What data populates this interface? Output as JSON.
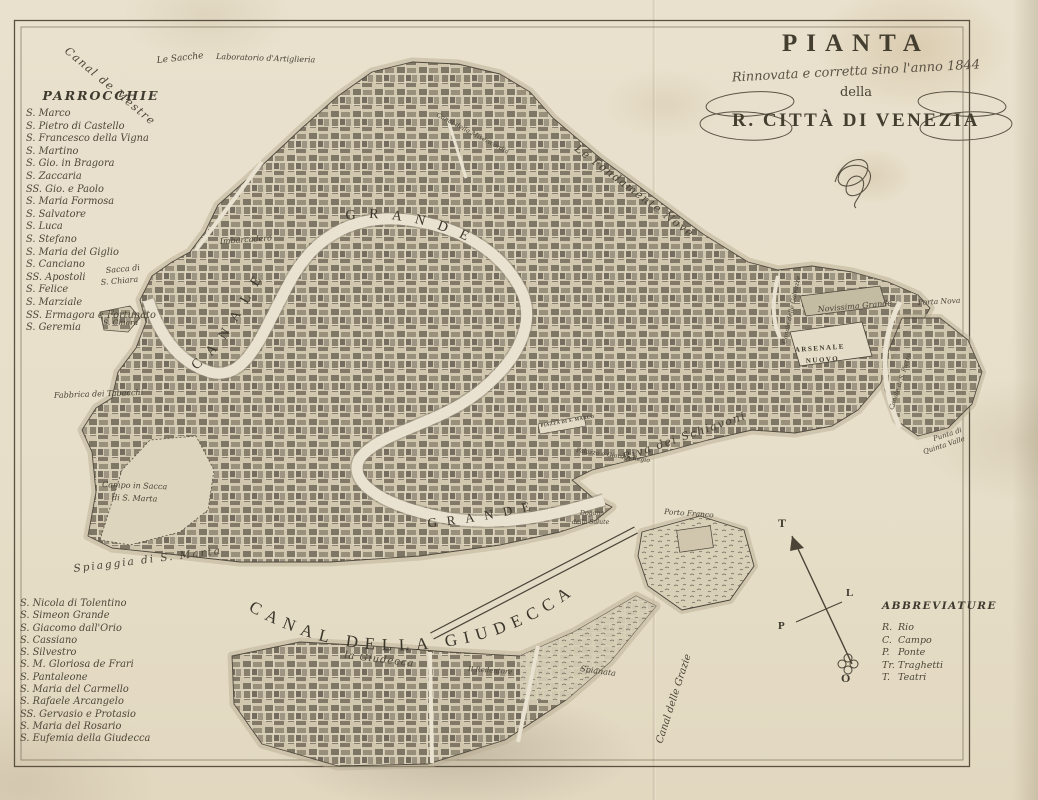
{
  "title_block": {
    "title": "PIANTA",
    "subtitle": "Rinnovata e corretta sino l'anno 1844",
    "della": "della",
    "city": "R. CITTÀ DI VENEZIA"
  },
  "parish_list": {
    "heading": "PARROCCHIE",
    "upper": [
      "S. Marco",
      "S. Pietro di Castello",
      "S. Francesco della Vigna",
      "S. Martino",
      "S. Gio. in Bragora",
      "S. Zaccaria",
      "SS. Gio. e Paolo",
      "S. Maria Formosa",
      "S. Salvatore",
      "S. Luca",
      "S. Stefano",
      "S. Maria del Giglio",
      "S. Canciano",
      "SS. Apostoli",
      "S. Felice",
      "S. Marziale",
      "SS. Ermagora e Fortunato",
      "S. Geremia"
    ],
    "lower": [
      "S. Nicola di Tolentino",
      "S. Simeon Grande",
      "S. Giacomo dall'Orio",
      "S. Cassiano",
      "S. Silvestro",
      "S. M. Gloriosa de Frari",
      "S. Pantaleone",
      "S. Maria del Carmello",
      "S. Rafaele Arcangelo",
      "SS. Gervasio e Protasio",
      "S. Maria del Rosario",
      "S. Eufemia della Giudecca"
    ]
  },
  "abbreviations": {
    "heading": "ABBREVIATURE",
    "items": [
      {
        "abbr": "R.",
        "term": "Rio"
      },
      {
        "abbr": "C.",
        "term": "Campo"
      },
      {
        "abbr": "P.",
        "term": "Ponte"
      },
      {
        "abbr": "Tr.",
        "term": "Traghetti"
      },
      {
        "abbr": "T.",
        "term": "Teatri"
      }
    ]
  },
  "compass": {
    "north": "T",
    "east": "L",
    "west": "P",
    "south": "O"
  },
  "canal_labels": {
    "canal": "CANALE",
    "grande_upper": "GRANDE",
    "grande_lower": "GRANDE",
    "giudecca": "CANAL DELLA GIUDECCA"
  },
  "colors": {
    "paper": "#e8e0cc",
    "ink": "#3f3a2f",
    "island": "#cfc6ad",
    "water": "#eae3d1"
  },
  "map_labels": [
    {
      "name": "label-canal-de-mestre",
      "text": "Canal de Mestre",
      "x": 64,
      "y": 52,
      "rot": 40,
      "size": 11,
      "cls": "script",
      "ls": 1.5
    },
    {
      "name": "label-le-sacche",
      "text": "Le Sacche",
      "x": 157,
      "y": 63,
      "rot": -6,
      "size": 9,
      "cls": "script"
    },
    {
      "name": "label-laboratorio-artiglieria",
      "text": "Laboratorio d'Artiglieria",
      "x": 216,
      "y": 59,
      "rot": 2,
      "size": 8,
      "cls": "script"
    },
    {
      "name": "label-fondamente-nove",
      "text": "Le Fondamente Nove",
      "x": 574,
      "y": 150,
      "rot": 37,
      "size": 11,
      "cls": "script",
      "ls": 1.5
    },
    {
      "name": "label-canal-misericordia",
      "text": "Canal della Misericordia",
      "x": 436,
      "y": 116,
      "rot": 28,
      "size": 6.5,
      "cls": "script"
    },
    {
      "name": "label-imbarcadero",
      "text": "Imbarcadero",
      "x": 220,
      "y": 244,
      "rot": -4,
      "size": 8,
      "cls": "script"
    },
    {
      "name": "label-sacca-s-chiara-line1",
      "text": "Sacca di",
      "x": 106,
      "y": 273,
      "rot": -5,
      "size": 8,
      "cls": "script"
    },
    {
      "name": "label-sacca-s-chiara-line2",
      "text": "S. Chiara",
      "x": 101,
      "y": 285,
      "rot": -5,
      "size": 8,
      "cls": "script"
    },
    {
      "name": "label-s-chiara",
      "text": "S. Chiara",
      "x": 103,
      "y": 325,
      "rot": 0,
      "size": 7.5,
      "cls": "script"
    },
    {
      "name": "label-fabbrica-tabacchi",
      "text": "Fabbrica dei Tabacchi",
      "x": 54,
      "y": 398,
      "rot": -2,
      "size": 8,
      "cls": "script"
    },
    {
      "name": "label-campo-sacca-line1",
      "text": "Campo in Sacca",
      "x": 102,
      "y": 487,
      "rot": 2,
      "size": 8,
      "cls": "script"
    },
    {
      "name": "label-campo-sacca-line2",
      "text": "di S. Marta",
      "x": 112,
      "y": 500,
      "rot": 2,
      "size": 8,
      "cls": "script"
    },
    {
      "name": "label-spiaggia-s-marta",
      "text": "Spiaggia di S. Marta",
      "x": 74,
      "y": 572,
      "rot": -7,
      "size": 10.5,
      "cls": "script",
      "ls": 2
    },
    {
      "name": "label-piazza-s-marco",
      "text": "PIAZZA DI S. MARCO",
      "x": 541,
      "y": 427,
      "rot": -10,
      "size": 4.6,
      "cls": "caps",
      "ls": 0.4
    },
    {
      "name": "label-palazzo-giardin-regio",
      "text": "Palazzo e Giardin Regio",
      "x": 576,
      "y": 452,
      "rot": 8,
      "size": 6.2,
      "cls": "script"
    },
    {
      "name": "label-riva-schiavoni",
      "text": "Riva dei Schiavoni",
      "x": 624,
      "y": 461,
      "rot": -19,
      "size": 11,
      "cls": "script",
      "ls": 1.5
    },
    {
      "name": "label-dogana-line1",
      "text": "Dogana",
      "x": 580,
      "y": 515,
      "rot": 0,
      "size": 6.2,
      "cls": "script"
    },
    {
      "name": "label-dogana-line2",
      "text": "della Salute",
      "x": 572,
      "y": 524,
      "rot": 0,
      "size": 6.2,
      "cls": "script"
    },
    {
      "name": "label-porto-franco",
      "text": "Porto Franco",
      "x": 664,
      "y": 514,
      "rot": 4,
      "size": 7.5,
      "cls": "script"
    },
    {
      "name": "label-spianata",
      "text": "Spianata",
      "x": 580,
      "y": 671,
      "rot": 8,
      "size": 8,
      "cls": "script"
    },
    {
      "name": "label-la-giudecca",
      "text": "la Giudecca",
      "x": 344,
      "y": 658,
      "rot": 7,
      "size": 10,
      "cls": "script",
      "ls": 1
    },
    {
      "name": "label-redentore",
      "text": "Il Redentore",
      "x": 468,
      "y": 671,
      "rot": 4,
      "size": 7,
      "cls": "script"
    },
    {
      "name": "label-canal-grazie",
      "text": "Canal delle Grazie",
      "x": 662,
      "y": 744,
      "rot": -72,
      "size": 10,
      "cls": "script"
    },
    {
      "name": "label-canale-galeazze",
      "text": "Canale delle Galeazze",
      "x": 786,
      "y": 344,
      "rot": -78,
      "size": 6.2,
      "cls": "script"
    },
    {
      "name": "label-canale-s-pietro",
      "text": "Canale di S. Pietro",
      "x": 893,
      "y": 410,
      "rot": -72,
      "size": 6.2,
      "cls": "script"
    },
    {
      "name": "label-novissima-grande",
      "text": "Novissima Grande",
      "x": 818,
      "y": 312,
      "rot": -5,
      "size": 8,
      "cls": "script"
    },
    {
      "name": "label-porta-nova",
      "text": "Porta Nova",
      "x": 918,
      "y": 305,
      "rot": -3,
      "size": 7.5,
      "cls": "script"
    },
    {
      "name": "label-arsenale-line1",
      "text": "ARSENALE",
      "x": 795,
      "y": 352,
      "rot": -4,
      "size": 7,
      "cls": "caps",
      "ls": 1.5
    },
    {
      "name": "label-arsenale-line2",
      "text": "NUOVO",
      "x": 806,
      "y": 363,
      "rot": -4,
      "size": 7,
      "cls": "caps",
      "ls": 1.5
    },
    {
      "name": "label-punta-quinta-line1",
      "text": "Punta di",
      "x": 934,
      "y": 441,
      "rot": -18,
      "size": 7,
      "cls": "script"
    },
    {
      "name": "label-punta-quinta-line2",
      "text": "Quinta Valle",
      "x": 924,
      "y": 454,
      "rot": -18,
      "size": 7,
      "cls": "script"
    },
    {
      "name": "compass-letter-north",
      "text": "T",
      "x": 778,
      "y": 527,
      "rot": 0,
      "size": 12,
      "cls": "caps"
    },
    {
      "name": "compass-letter-east",
      "text": "L",
      "x": 846,
      "y": 596,
      "rot": 0,
      "size": 11,
      "cls": "caps"
    },
    {
      "name": "compass-letter-west",
      "text": "P",
      "x": 778,
      "y": 629,
      "rot": 0,
      "size": 11,
      "cls": "caps"
    },
    {
      "name": "compass-letter-south",
      "text": "O",
      "x": 841,
      "y": 682,
      "rot": 0,
      "size": 12,
      "cls": "caps"
    }
  ]
}
